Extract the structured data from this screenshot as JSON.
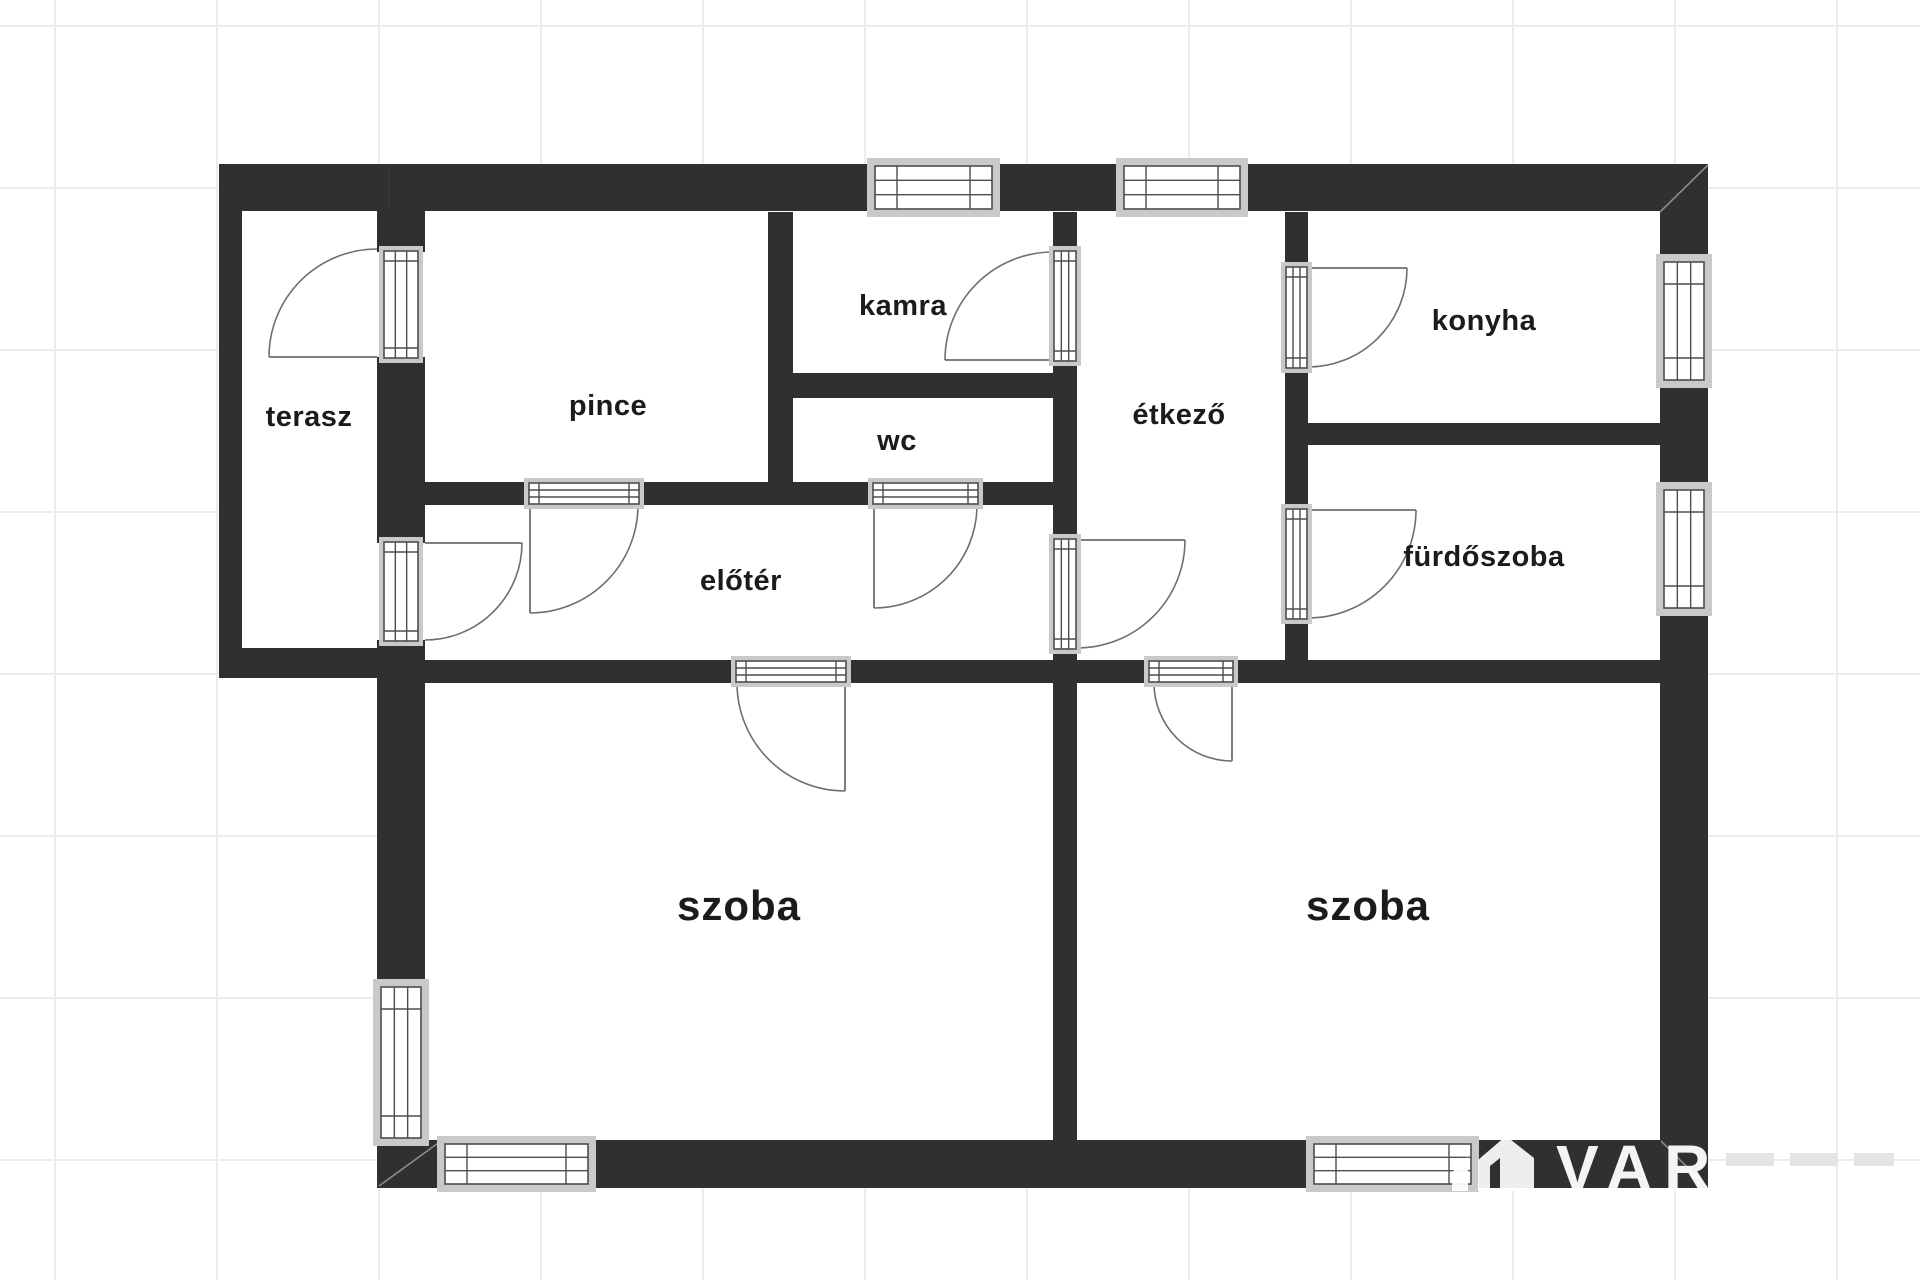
{
  "plan": {
    "rooms": [
      {
        "id": "terasz",
        "label": "terasz"
      },
      {
        "id": "pince",
        "label": "pince"
      },
      {
        "id": "kamra",
        "label": "kamra"
      },
      {
        "id": "wc",
        "label": "wc"
      },
      {
        "id": "etkezo",
        "label": "étkező"
      },
      {
        "id": "konyha",
        "label": "konyha"
      },
      {
        "id": "furdoszoba",
        "label": "fürdőszoba"
      },
      {
        "id": "eloter",
        "label": "előtér"
      },
      {
        "id": "szoba_left",
        "label": "szoba"
      },
      {
        "id": "szoba_right",
        "label": "szoba"
      }
    ],
    "counts": {
      "windows": 7,
      "doors": 10
    },
    "watermark": {
      "text": "VAR",
      "logo": "house-logo"
    },
    "colors": {
      "wall": "#303030",
      "background": "#ffffff",
      "grid": "#ececec",
      "frame": "#c9c9c9",
      "line": "#4d4d4d",
      "arc": "#6e6e6e",
      "label": "#1b1b1b",
      "watermark": "#ffffff"
    }
  }
}
